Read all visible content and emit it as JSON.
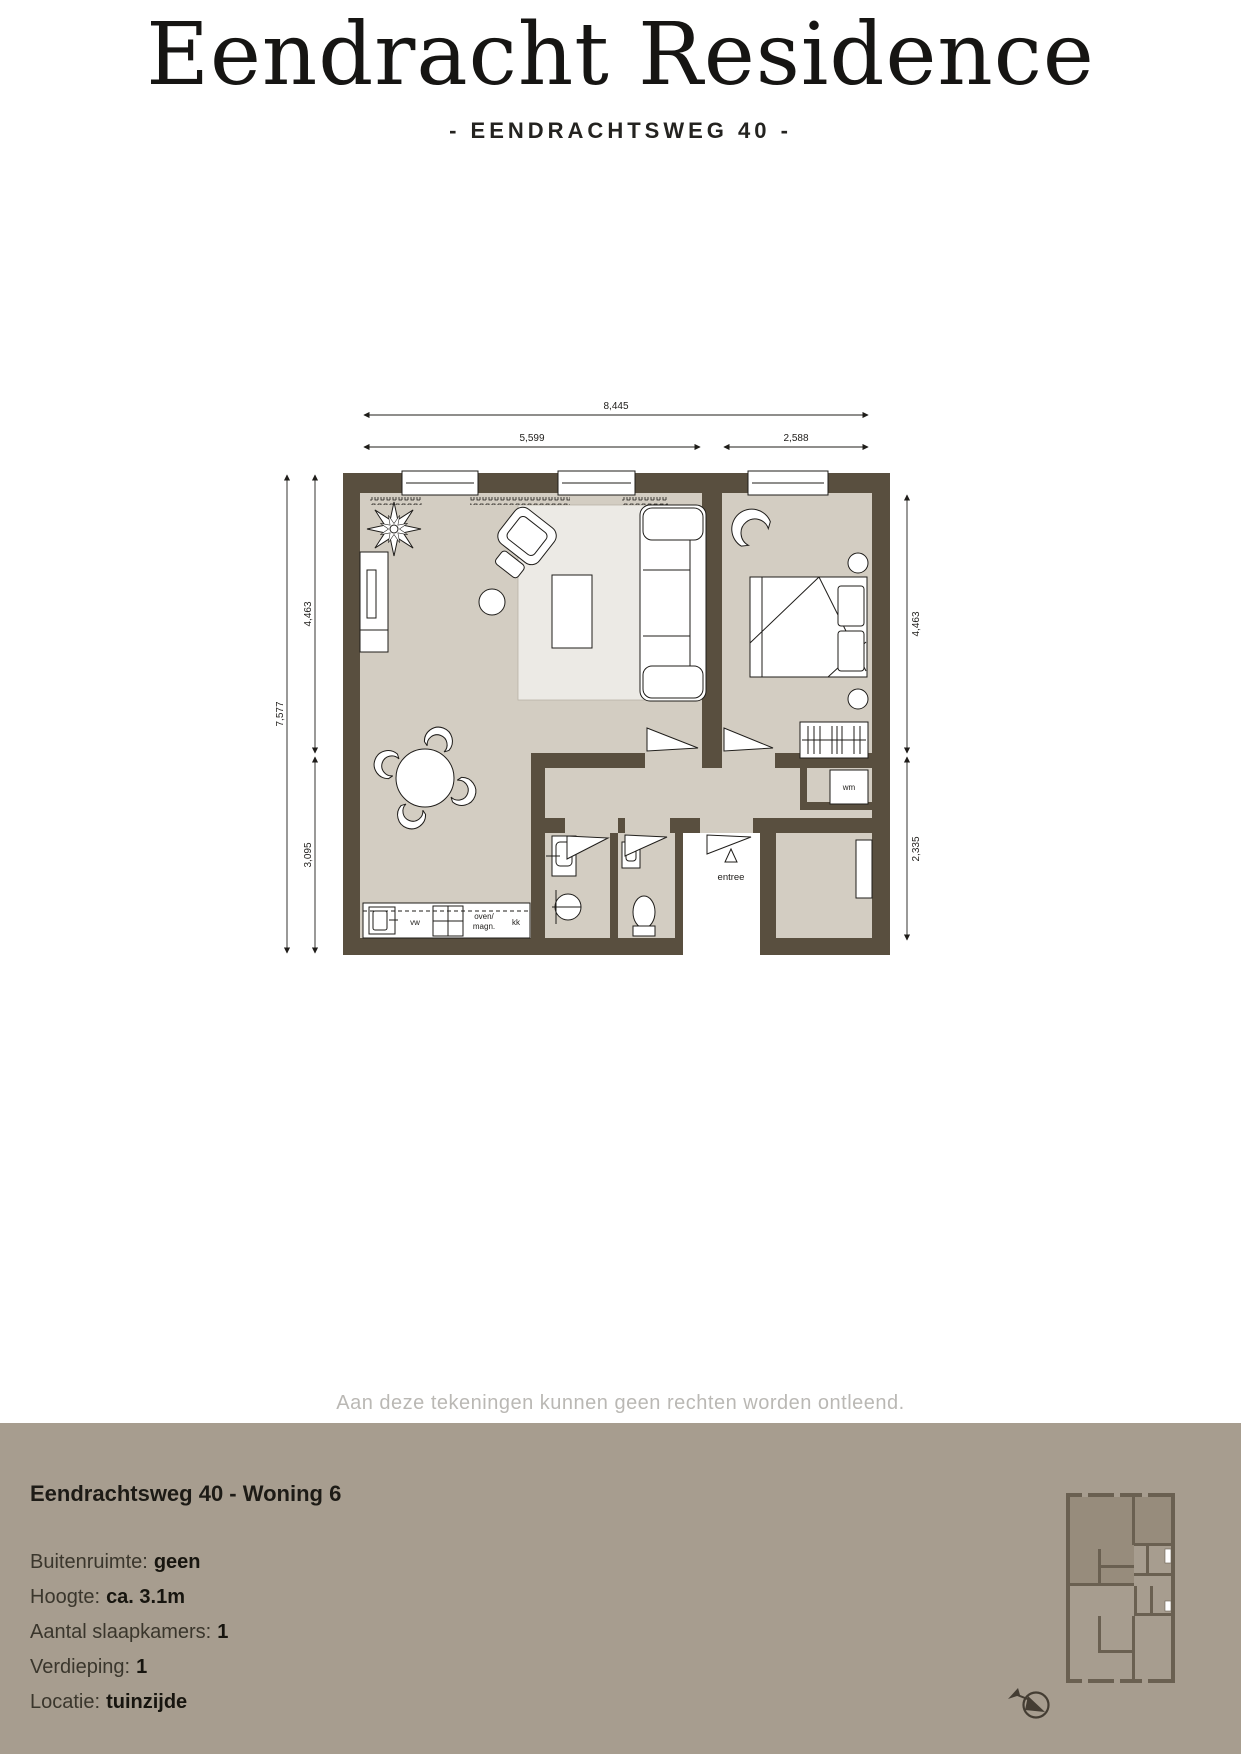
{
  "header": {
    "title": "Eendracht Residence",
    "subtitle": "- EENDRACHTSWEG 40 -"
  },
  "plan": {
    "dims": {
      "total_width": "8,445",
      "living_width": "5,599",
      "bedroom_width": "2,588",
      "total_height": "7,577",
      "left_upper": "4,463",
      "left_lower": "3,095",
      "right_upper": "4,463",
      "right_lower": "2,335"
    },
    "labels": {
      "entree": "entree",
      "wm": "wm",
      "vw": "vw",
      "oven_line1": "oven/",
      "oven_line2": "magn.",
      "kk": "kk"
    }
  },
  "disclaimer": "Aan deze tekeningen kunnen geen rechten worden ontleend.",
  "footer": {
    "title": "Eendrachtsweg 40 - Woning 6",
    "specs": [
      {
        "label": "Buitenruimte:",
        "value": "geen"
      },
      {
        "label": "Hoogte:",
        "value": "ca. 3.1m"
      },
      {
        "label": "Aantal slaapkamers:",
        "value": "1"
      },
      {
        "label": "Verdieping:",
        "value": "1"
      },
      {
        "label": "Locatie:",
        "value": "tuinzijde"
      }
    ]
  },
  "colors": {
    "wall": "#594f3f",
    "floor": "#d3cdc2",
    "footer_bg": "#a79d8f",
    "disclaimer_text": "#bab8b4",
    "text_dark": "#1d1b16"
  }
}
